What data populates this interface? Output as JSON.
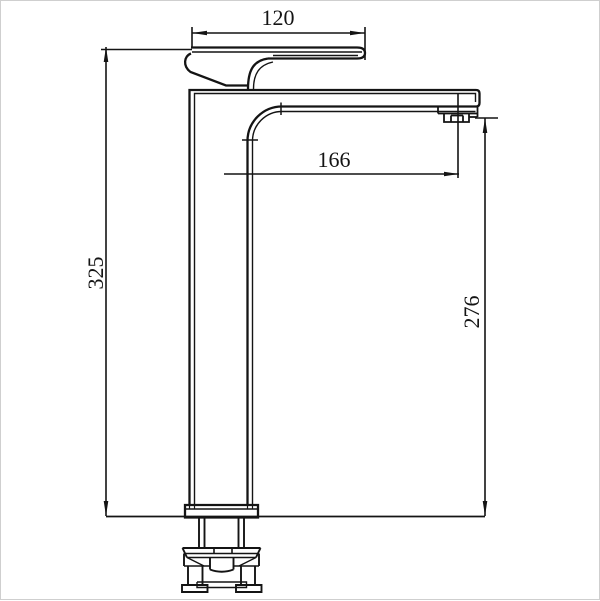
{
  "canvas": {
    "background": "#ffffff",
    "frame_color": "#cfcfcf",
    "line_color": "#141414"
  },
  "drawing": {
    "kind": "technical-dimension-diagram",
    "subject": "tall-single-lever-basin-mixer-faucet-side-elevation",
    "dimensions": {
      "handle_width": "120",
      "spout_reach": "166",
      "overall_height": "325",
      "outlet_height": "276"
    }
  }
}
